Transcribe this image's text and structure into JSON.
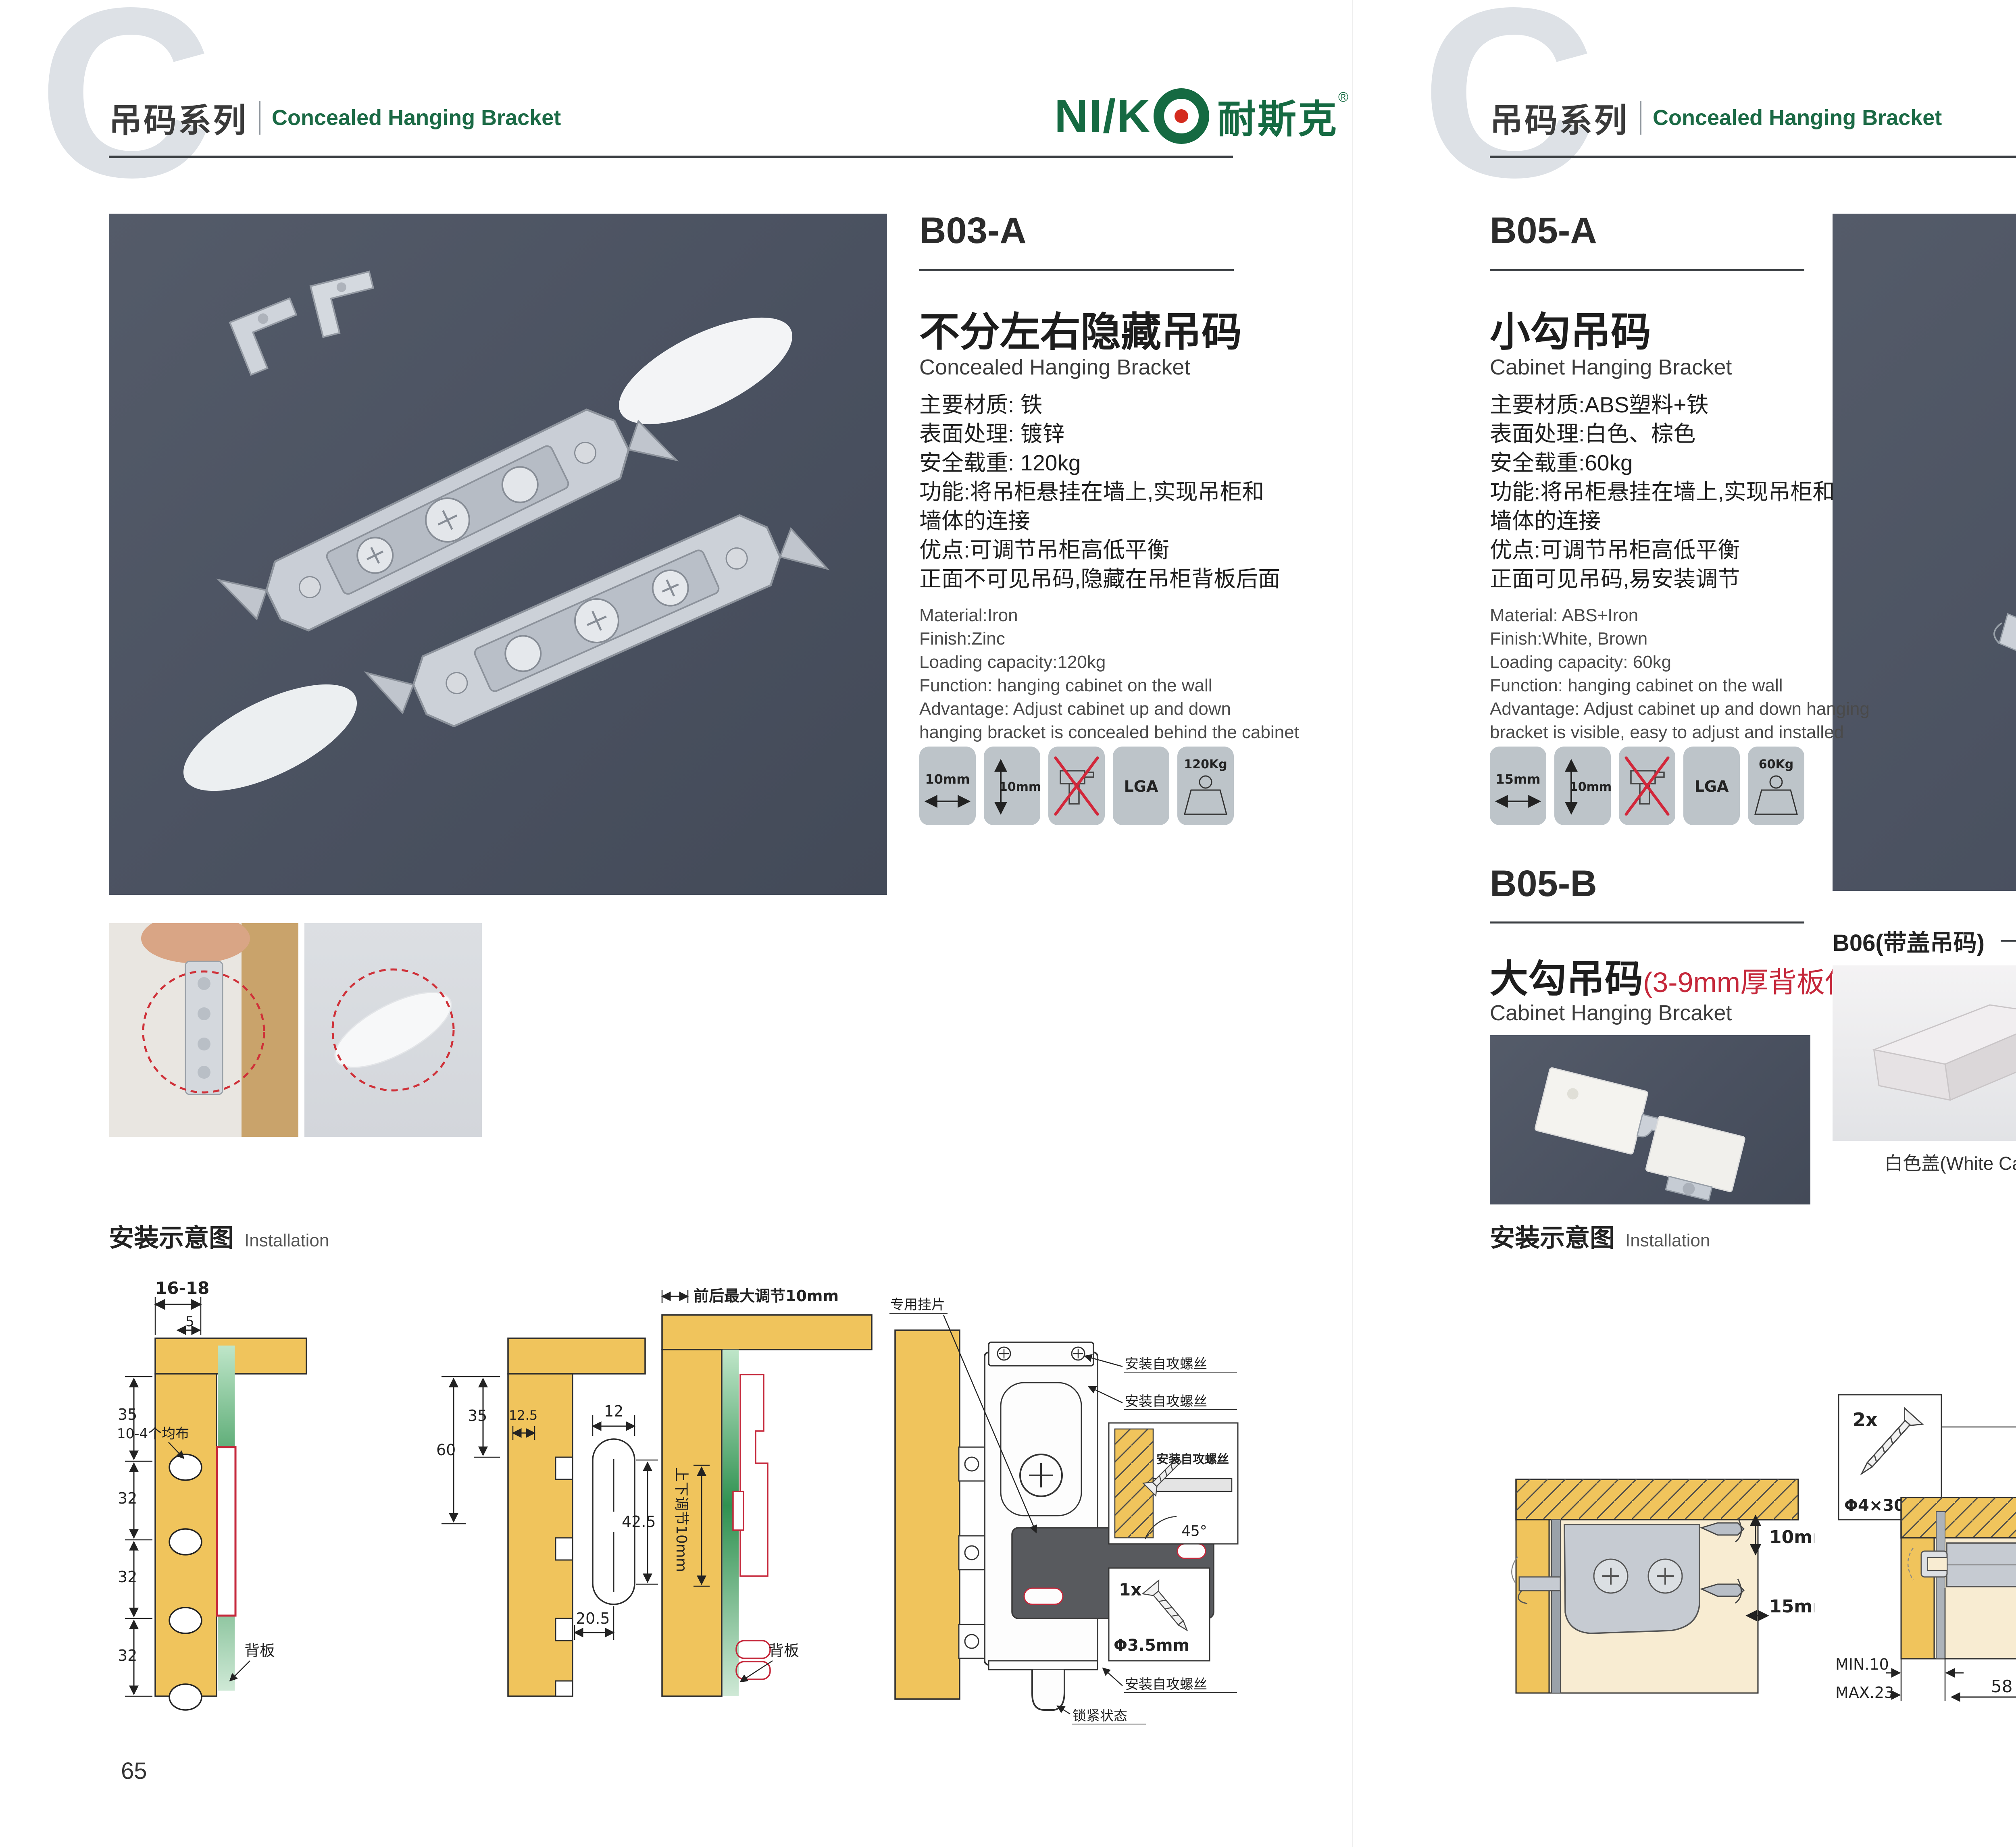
{
  "colors": {
    "accent_green": "#1B6A45",
    "logo_red": "#D42B1E",
    "red_accent": "#C5273A",
    "photo_bg": "#4C5363",
    "wood": "#F0C45C",
    "pale_wood": "#F8ECD2",
    "icon_bg": "#BDC4C9"
  },
  "header": {
    "big_letter": "C",
    "series_cn": "吊码系列",
    "series_en": "Concealed Hanging Bracket"
  },
  "logo": {
    "latin": "NI/K",
    "cn": "耐斯克",
    "reg": "®"
  },
  "left": {
    "page_number": "65",
    "product": {
      "code": "B03-A",
      "name_cn": "不分左右隐藏吊码",
      "name_en": "Concealed Hanging Bracket",
      "specs_cn": [
        "主要材质: 铁",
        "表面处理: 镀锌",
        "安全载重: 120kg",
        "功能:将吊柜悬挂在墙上,实现吊柜和",
        "墙体的连接",
        "优点:可调节吊柜高低平衡",
        "正面不可见吊码,隐藏在吊柜背板后面"
      ],
      "specs_en": [
        "Material:Iron",
        "Finish:Zinc",
        "Loading capacity:120kg",
        "Function: hanging cabinet on the wall",
        "Advantage: Adjust cabinet up and down",
        "hanging bracket is concealed behind the cabinet"
      ]
    },
    "icons": {
      "i1": "10mm",
      "i2": "10mm",
      "i4": "LGA",
      "i5": "120Kg"
    },
    "installation": {
      "cn": "安装示意图",
      "en": "Installation"
    },
    "d1": {
      "dim_top": "16-18",
      "dim_top2": "5",
      "dims_left": [
        "35",
        "32",
        "32",
        "32"
      ],
      "callout_holes": "10-4个均布",
      "label_back": "背板"
    },
    "d2": {
      "dim_60": "60",
      "dim_35": "35",
      "dim_125": "12.5",
      "dim_12": "12",
      "dim_425": "42.5",
      "dim_205": "20.5"
    },
    "d3": {
      "label_top": "前后最大调节10mm",
      "label_left": "上下调节10mm",
      "label_back": "背板"
    },
    "d4": {
      "label_screw1": "安装自攻螺丝",
      "label_screw2": "安装自攻螺丝",
      "label_plate": "专用挂片",
      "label_screw3": "安装自攻螺丝",
      "label_lock": "锁紧状态",
      "inset_label": "安装自攻螺丝",
      "inset_angle": "45°",
      "inset_qty": "1x",
      "inset_dia": "Φ3.5mm"
    }
  },
  "right": {
    "page_number": "66",
    "b05a": {
      "code": "B05-A",
      "name_cn": "小勾吊码",
      "name_en": "Cabinet Hanging Bracket",
      "specs_cn": [
        "主要材质:ABS塑料+铁",
        "表面处理:白色、棕色",
        "安全载重:60kg",
        "功能:将吊柜悬挂在墙上,实现吊柜和",
        "墙体的连接",
        "优点:可调节吊柜高低平衡",
        "正面可见吊码,易安装调节"
      ],
      "specs_en": [
        "Material: ABS+Iron",
        "Finish:White, Brown",
        "Loading capacity: 60kg",
        "Function: hanging cabinet on the wall",
        "Advantage: Adjust cabinet up and down hanging",
        "bracket is visible, easy to adjust and installed"
      ]
    },
    "icons": {
      "i1": "15mm",
      "i2": "10mm",
      "i4": "LGA",
      "i5": "60Kg"
    },
    "b05b": {
      "code": "B05-B",
      "name_cn": "大勾吊码",
      "name_red": "(3-9mm厚背板使用)",
      "name_en": "Cabinet Hanging Brcaket"
    },
    "b06": {
      "label": "B06(带盖吊码)"
    },
    "caps": [
      "白色盖(White Cap)",
      "灰色盖(Gray Cap)",
      "银色盖(Silver Cap)"
    ],
    "installation": {
      "cn": "安装示意图",
      "en": "Installation"
    },
    "r1": {
      "dim_v": "10mm",
      "dim_h": "15mm"
    },
    "r2": {
      "qty": "2x",
      "dia": "Φ4×30mm",
      "dim_18": "18",
      "min": "MIN.10",
      "max": "MAX.23",
      "dim_58": "58"
    },
    "r3": {
      "dim_16": "16",
      "dim_42": "42",
      "dim_r": "RMAX4",
      "dim_17": "17",
      "dim_32": "32"
    }
  }
}
